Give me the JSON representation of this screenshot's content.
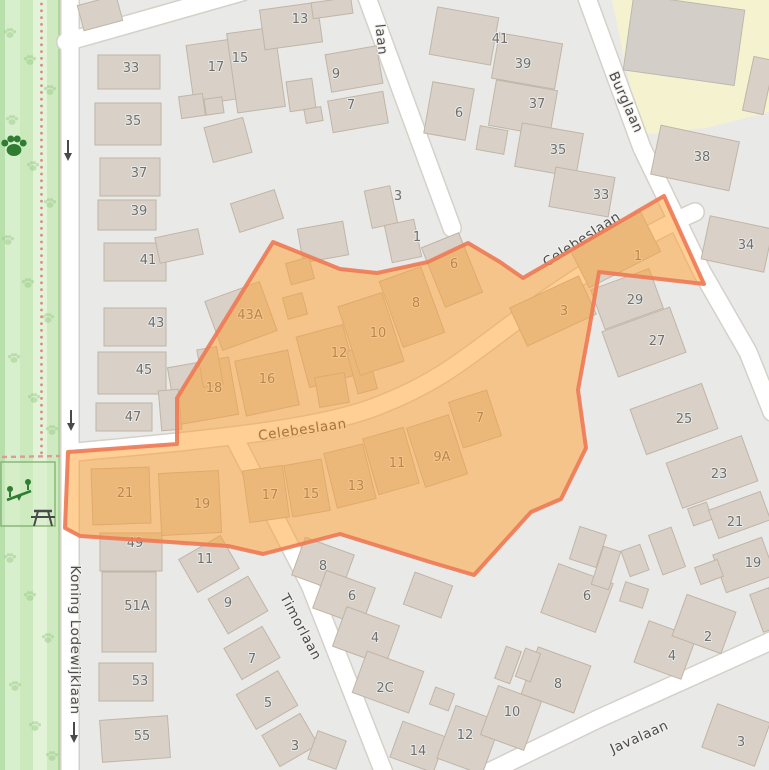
{
  "map": {
    "colors": {
      "background": "#e9e9e7",
      "building_fill": "#d9d0c7",
      "building_stroke": "#c0b5a6",
      "road_fill": "#ffffff",
      "park_light": "#d8efcd",
      "park_medium": "#c6e7b8",
      "park_dark_stripe": "#b7e0ab",
      "school_area": "#f5f2d0",
      "highlight_fill": "rgba(255,160,45,0.5)",
      "highlight_stroke": "rgba(238,123,86,0.92)",
      "path_dot": "#d98c86",
      "icon_green": "#2e7d32",
      "icon_gray": "#4a4a4a"
    },
    "streets": [
      {
        "name": "Koning Lodewijklaan",
        "x": 71,
        "y": 640,
        "rot": 90
      },
      {
        "name": "Celebeslaan",
        "x": 303,
        "y": 434,
        "rot": -8
      },
      {
        "name": "Celebeslaan",
        "x": 584,
        "y": 243,
        "rot": -33
      },
      {
        "name": "Burglaan",
        "x": 622,
        "y": 104,
        "rot": 66
      },
      {
        "name": "Timorlaan",
        "x": 297,
        "y": 629,
        "rot": 62
      },
      {
        "name": "Javalaan",
        "x": 641,
        "y": 741,
        "rot": -24
      },
      {
        "name": "laan",
        "x": 377,
        "y": 40,
        "rot": 84
      }
    ],
    "house_numbers": [
      [
        "33",
        131,
        72
      ],
      [
        "35",
        133,
        125
      ],
      [
        "37",
        139,
        177
      ],
      [
        "39",
        139,
        215
      ],
      [
        "41",
        148,
        264
      ],
      [
        "43",
        156,
        327
      ],
      [
        "45",
        144,
        374
      ],
      [
        "47",
        133,
        421
      ],
      [
        "49",
        135,
        547
      ],
      [
        "51A",
        137,
        610
      ],
      [
        "53",
        140,
        685
      ],
      [
        "55",
        142,
        740
      ],
      [
        "17",
        216,
        71
      ],
      [
        "15",
        240,
        62
      ],
      [
        "13",
        300,
        23
      ],
      [
        "9",
        336,
        78
      ],
      [
        "7",
        351,
        109
      ],
      [
        "3",
        398,
        200
      ],
      [
        "1",
        417,
        241
      ],
      [
        "41",
        500,
        43
      ],
      [
        "39",
        523,
        68
      ],
      [
        "37",
        537,
        108
      ],
      [
        "35",
        558,
        154
      ],
      [
        "33",
        601,
        199
      ],
      [
        "6",
        459,
        117
      ],
      [
        "38",
        702,
        161
      ],
      [
        "34",
        746,
        249
      ],
      [
        "29",
        635,
        304
      ],
      [
        "27",
        657,
        345
      ],
      [
        "25",
        684,
        423
      ],
      [
        "23",
        719,
        478
      ],
      [
        "21",
        735,
        526
      ],
      [
        "19",
        753,
        567
      ],
      [
        "43A",
        250,
        319
      ],
      [
        "18",
        214,
        392
      ],
      [
        "16",
        267,
        383
      ],
      [
        "12",
        339,
        357
      ],
      [
        "10",
        378,
        337
      ],
      [
        "8",
        416,
        307
      ],
      [
        "6",
        454,
        268
      ],
      [
        "3",
        564,
        315
      ],
      [
        "1",
        638,
        260
      ],
      [
        "7",
        480,
        422
      ],
      [
        "9A",
        442,
        461
      ],
      [
        "11",
        397,
        467
      ],
      [
        "13",
        356,
        490
      ],
      [
        "15",
        311,
        498
      ],
      [
        "17",
        270,
        499
      ],
      [
        "19",
        202,
        508
      ],
      [
        "21",
        125,
        497
      ],
      [
        "11",
        205,
        563
      ],
      [
        "9",
        228,
        607
      ],
      [
        "7",
        252,
        663
      ],
      [
        "5",
        268,
        707
      ],
      [
        "3",
        295,
        750
      ],
      [
        "8",
        323,
        570
      ],
      [
        "6",
        352,
        600
      ],
      [
        "4",
        375,
        642
      ],
      [
        "2C",
        385,
        692
      ],
      [
        "14",
        418,
        755
      ],
      [
        "12",
        465,
        739
      ],
      [
        "10",
        512,
        716
      ],
      [
        "6",
        587,
        600
      ],
      [
        "8",
        558,
        688
      ],
      [
        "4",
        672,
        660
      ],
      [
        "2",
        708,
        641
      ],
      [
        "3",
        741,
        746
      ]
    ],
    "buildings": [
      [
        98,
        55,
        62,
        34,
        0
      ],
      [
        95,
        103,
        66,
        42,
        0
      ],
      [
        100,
        158,
        60,
        38,
        0
      ],
      [
        98,
        200,
        58,
        30,
        0
      ],
      [
        104,
        243,
        62,
        38,
        0
      ],
      [
        104,
        308,
        62,
        38,
        0
      ],
      [
        98,
        352,
        68,
        42,
        0
      ],
      [
        96,
        403,
        56,
        28,
        0
      ],
      [
        100,
        533,
        62,
        38,
        0
      ],
      [
        102,
        572,
        54,
        80,
        0
      ],
      [
        99,
        663,
        54,
        38,
        0
      ],
      [
        101,
        718,
        68,
        42,
        -4
      ],
      [
        80,
        0,
        40,
        26,
        -15
      ],
      [
        190,
        42,
        46,
        60,
        -8
      ],
      [
        232,
        30,
        48,
        80,
        -8
      ],
      [
        262,
        6,
        58,
        40,
        -8
      ],
      [
        312,
        0,
        40,
        16,
        -8
      ],
      [
        288,
        80,
        26,
        30,
        -8
      ],
      [
        180,
        95,
        24,
        22,
        -8
      ],
      [
        205,
        98,
        18,
        16,
        -8
      ],
      [
        208,
        122,
        40,
        36,
        -15
      ],
      [
        234,
        196,
        46,
        30,
        -18
      ],
      [
        157,
        233,
        44,
        26,
        -12
      ],
      [
        328,
        50,
        52,
        38,
        -10
      ],
      [
        330,
        96,
        56,
        32,
        -10
      ],
      [
        305,
        108,
        17,
        14,
        -10
      ],
      [
        368,
        188,
        26,
        38,
        -12
      ],
      [
        388,
        222,
        30,
        38,
        -12
      ],
      [
        300,
        225,
        46,
        34,
        -10
      ],
      [
        433,
        12,
        62,
        48,
        10
      ],
      [
        495,
        38,
        64,
        46,
        10
      ],
      [
        492,
        85,
        62,
        46,
        10
      ],
      [
        518,
        128,
        62,
        44,
        10
      ],
      [
        552,
        172,
        60,
        40,
        10
      ],
      [
        428,
        85,
        42,
        52,
        10
      ],
      [
        478,
        128,
        28,
        24,
        10
      ],
      [
        655,
        133,
        80,
        50,
        12
      ],
      [
        705,
        222,
        64,
        44,
        12
      ],
      [
        748,
        58,
        21,
        55,
        12
      ],
      [
        596,
        278,
        62,
        42,
        -20
      ],
      [
        608,
        318,
        72,
        48,
        -20
      ],
      [
        636,
        395,
        76,
        48,
        -20
      ],
      [
        672,
        448,
        80,
        48,
        -20
      ],
      [
        690,
        505,
        20,
        18,
        -20
      ],
      [
        712,
        500,
        55,
        30,
        -20
      ],
      [
        718,
        545,
        52,
        40,
        -20
      ],
      [
        655,
        530,
        24,
        42,
        -20
      ],
      [
        625,
        547,
        20,
        27,
        -20
      ],
      [
        697,
        563,
        24,
        18,
        -20
      ],
      [
        756,
        590,
        20,
        40,
        -20
      ],
      [
        185,
        545,
        48,
        38,
        -30
      ],
      [
        215,
        585,
        46,
        40,
        -30
      ],
      [
        230,
        635,
        44,
        36,
        -30
      ],
      [
        243,
        680,
        48,
        40,
        -30
      ],
      [
        268,
        722,
        44,
        36,
        -30
      ],
      [
        297,
        545,
        52,
        40,
        20
      ],
      [
        318,
        578,
        52,
        40,
        20
      ],
      [
        338,
        615,
        56,
        42,
        20
      ],
      [
        358,
        660,
        60,
        44,
        20
      ],
      [
        408,
        578,
        40,
        34,
        20
      ],
      [
        312,
        735,
        30,
        30,
        20
      ],
      [
        395,
        728,
        46,
        38,
        20
      ],
      [
        445,
        712,
        48,
        56,
        20
      ],
      [
        488,
        692,
        46,
        52,
        20
      ],
      [
        432,
        690,
        20,
        18,
        20
      ],
      [
        548,
        572,
        58,
        52,
        20
      ],
      [
        528,
        655,
        56,
        50,
        20
      ],
      [
        640,
        628,
        50,
        44,
        20
      ],
      [
        678,
        602,
        52,
        44,
        20
      ],
      [
        708,
        712,
        56,
        46,
        20
      ],
      [
        574,
        530,
        28,
        34,
        18
      ],
      [
        597,
        548,
        18,
        40,
        18
      ],
      [
        622,
        585,
        24,
        20,
        18
      ],
      [
        500,
        648,
        16,
        34,
        20
      ],
      [
        520,
        650,
        16,
        30,
        20
      ],
      [
        212,
        290,
        58,
        52,
        -20
      ],
      [
        288,
        260,
        24,
        22,
        -15
      ],
      [
        285,
        295,
        20,
        22,
        -15
      ],
      [
        172,
        362,
        62,
        58,
        -10
      ],
      [
        160,
        390,
        20,
        40,
        -5
      ],
      [
        240,
        355,
        54,
        56,
        -12
      ],
      [
        302,
        330,
        48,
        52,
        -15
      ],
      [
        352,
        348,
        20,
        44,
        -15
      ],
      [
        317,
        375,
        30,
        30,
        -10
      ],
      [
        348,
        298,
        46,
        72,
        -18
      ],
      [
        390,
        272,
        44,
        70,
        -20
      ],
      [
        432,
        238,
        40,
        64,
        -22
      ],
      [
        515,
        290,
        76,
        42,
        -25
      ],
      [
        575,
        228,
        80,
        44,
        -27
      ],
      [
        455,
        395,
        40,
        48,
        -18
      ],
      [
        415,
        420,
        44,
        62,
        -18
      ],
      [
        370,
        432,
        42,
        58,
        -16
      ],
      [
        330,
        448,
        40,
        56,
        -14
      ],
      [
        288,
        462,
        38,
        52,
        -10
      ],
      [
        246,
        468,
        40,
        52,
        -8
      ],
      [
        160,
        472,
        60,
        62,
        -3
      ],
      [
        92,
        468,
        58,
        56,
        -2
      ],
      [
        200,
        348,
        20,
        38,
        -10
      ]
    ],
    "school_building": [
      628,
      2,
      112,
      76,
      8
    ],
    "highlight_polygon": {
      "points": "65,528 68,452 177,444 177,398 273,242 340,269 377,273 428,262 468,243 500,262 523,278 664,196 704,284 599,272 589,330 578,390 586,448 561,499 531,512 474,575 430,562 340,534 263,554 228,546 80,536"
    },
    "paw_watermarks": [
      [
        10,
        35
      ],
      [
        30,
        62
      ],
      [
        50,
        92
      ],
      [
        12,
        122
      ],
      [
        33,
        168
      ],
      [
        50,
        205
      ],
      [
        8,
        242
      ],
      [
        28,
        285
      ],
      [
        48,
        320
      ],
      [
        14,
        360
      ],
      [
        34,
        400
      ],
      [
        52,
        432
      ],
      [
        10,
        560
      ],
      [
        30,
        598
      ],
      [
        48,
        640
      ],
      [
        15,
        688
      ],
      [
        35,
        728
      ],
      [
        52,
        758
      ]
    ],
    "oneway_arrows": [
      [
        68,
        140
      ],
      [
        71,
        410
      ],
      [
        74,
        722
      ]
    ]
  }
}
